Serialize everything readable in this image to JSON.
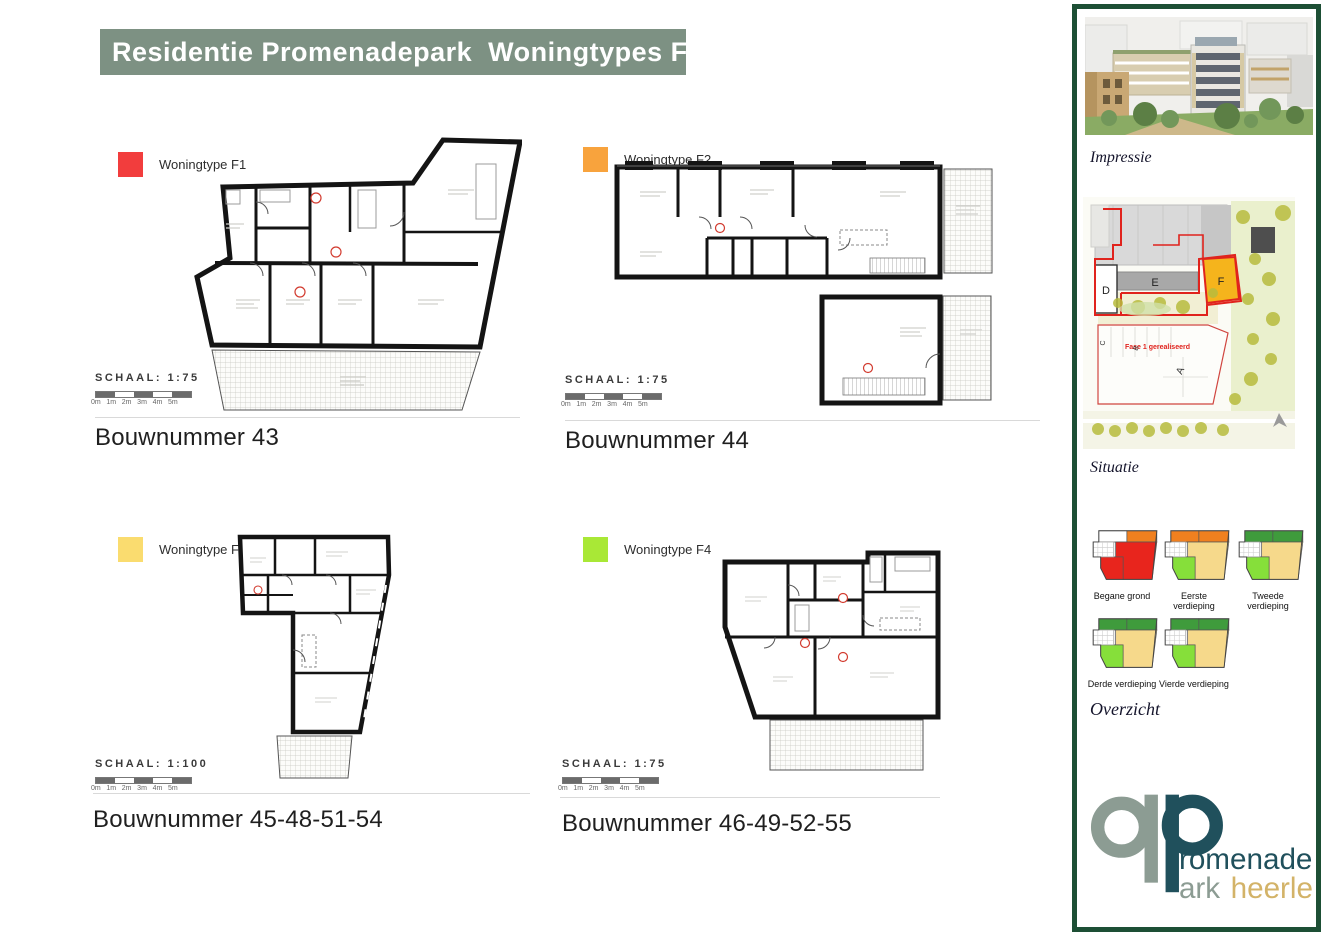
{
  "title": "Residentie Promenadepark  Woningtypes F",
  "plans": [
    {
      "legend": "Woningtype F1",
      "color": "#f23d3d",
      "schaal": "SCHAAL:  1:75",
      "bouwnummer": "Bouwnummer 43"
    },
    {
      "legend": "Woningtype F2",
      "color": "#f8a33d",
      "schaal": "SCHAAL:  1:75",
      "bouwnummer": "Bouwnummer 44"
    },
    {
      "legend": "Woningtype F3",
      "color": "#fadc6f",
      "schaal": "SCHAAL:  1:100",
      "bouwnummer": "Bouwnummer 45-48-51-54"
    },
    {
      "legend": "Woningtype F4",
      "color": "#a9e836",
      "schaal": "SCHAAL:  1:75",
      "bouwnummer": "Bouwnummer 46-49-52-55"
    }
  ],
  "scalebar": {
    "labels": [
      "0m",
      "1m",
      "2m",
      "3m",
      "4m",
      "5m"
    ]
  },
  "sidebar": {
    "impressie": "Impressie",
    "situatie": "Situatie",
    "overzicht": "Overzicht",
    "map": {
      "d": "D",
      "e": "E",
      "f": "F",
      "a": "A",
      "b": "B",
      "c": "C",
      "fase": "Fase 1 gerealiseerd"
    },
    "floors": [
      {
        "label": "Begane grond",
        "colors": {
          "top_left": "#ffffff",
          "top_right": "#f0801f",
          "bottom_left": "#e8251d",
          "bottom_right": "#e8251d"
        }
      },
      {
        "label": "Eerste verdieping",
        "colors": {
          "top_left": "#f0801f",
          "top_right": "#f0801f",
          "bottom_left": "#86df3a",
          "bottom_right": "#f6d98b"
        }
      },
      {
        "label": "Tweede verdieping",
        "colors": {
          "top_left": "#3f9b3c",
          "top_right": "#3f9b3c",
          "bottom_left": "#86df3a",
          "bottom_right": "#f6d98b"
        }
      },
      {
        "label": "Derde verdieping",
        "colors": {
          "top_left": "#3f9b3c",
          "top_right": "#3f9b3c",
          "bottom_left": "#86df3a",
          "bottom_right": "#f6d98b"
        }
      },
      {
        "label": "Vierde verdieping",
        "colors": {
          "top_left": "#3f9b3c",
          "top_right": "#3f9b3c",
          "bottom_left": "#86df3a",
          "bottom_right": "#f6d98b"
        }
      }
    ],
    "logo": {
      "p1": "romenade",
      "p2": "ark",
      "p3": "heerlen"
    }
  },
  "colors": {
    "title_bg": "#7d9183",
    "sidebar_border": "#1d4f35",
    "accent_red": "#d23b2f"
  }
}
